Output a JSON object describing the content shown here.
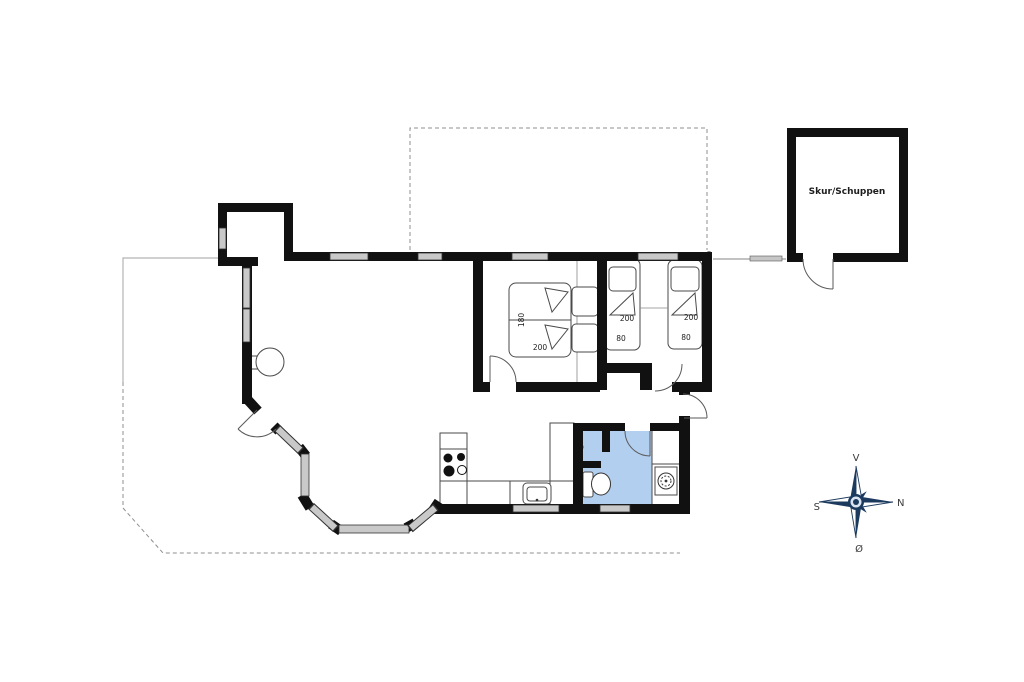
{
  "plan": {
    "shed": {
      "label": "Skur/Schuppen"
    },
    "rooms": {
      "double_bedroom": {
        "bed_width_label": "180",
        "bed_length_label": "200"
      },
      "single_bedroom_1": {
        "bed_length_label": "200",
        "bed_width_label": "80"
      },
      "single_bedroom_2": {
        "bed_length_label": "200",
        "bed_width_label": "80"
      }
    },
    "compass": {
      "top": "V",
      "right": "N",
      "left": "S",
      "bottom": "Ø"
    },
    "colors": {
      "wall": "#111111",
      "window": "#c9c9c9",
      "bathroom": "#b3cfef",
      "compass": "#1b3a5e"
    }
  }
}
